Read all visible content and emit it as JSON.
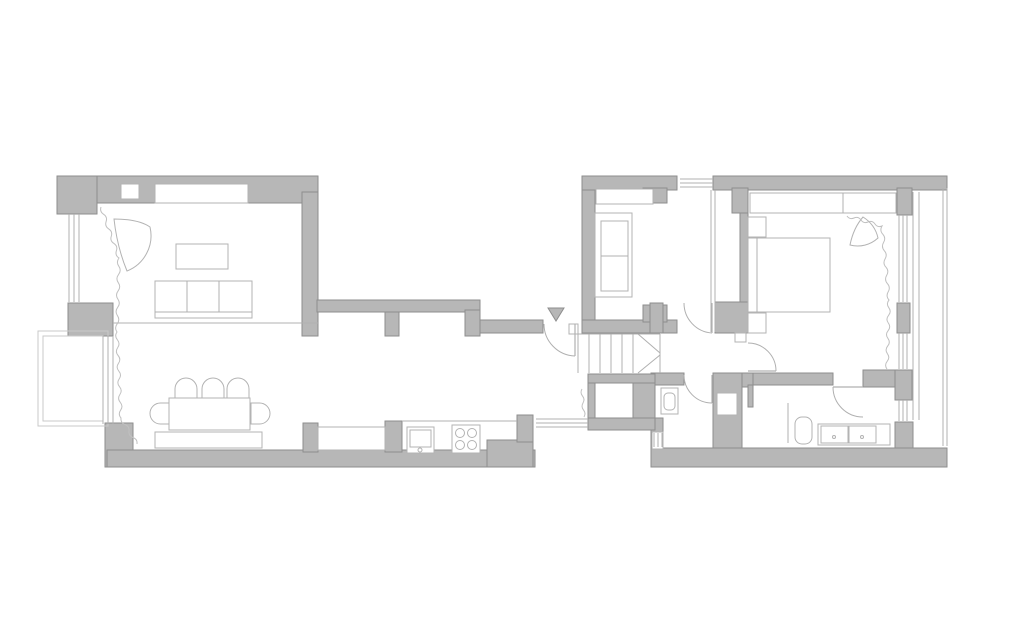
{
  "meta": {
    "title": "apartment-floor-plan",
    "canvas_width": 1024,
    "canvas_height": 633
  },
  "palette": {
    "background": "#ffffff",
    "wall_fill": "#b7b7b7",
    "wall_stroke": "#8e8e8e",
    "line": "#b0b0b0",
    "furniture_fill": "#ffffff",
    "furniture_stroke": "#b3b3b3",
    "curtain": "#c0c0c0",
    "door": "#b0b0b0",
    "outline": "#c9c9c9"
  },
  "floorplan": {
    "walls": [
      {
        "name": "wall-living-top",
        "x": 57,
        "y": 176,
        "w": 261,
        "h": 27
      },
      {
        "name": "wall-living-top-left-corner",
        "x": 57,
        "y": 176,
        "w": 40,
        "h": 38
      },
      {
        "name": "wall-living-right",
        "x": 302,
        "y": 192,
        "w": 16,
        "h": 144
      },
      {
        "name": "wall-corridor-top-band",
        "x": 317,
        "y": 300,
        "w": 163,
        "h": 12
      },
      {
        "name": "wall-corridor-pier-1",
        "x": 385,
        "y": 312,
        "w": 14,
        "h": 24
      },
      {
        "name": "wall-corridor-pier-2",
        "x": 465,
        "y": 310,
        "w": 15,
        "h": 26
      },
      {
        "name": "wall-entry-band",
        "x": 480,
        "y": 320,
        "w": 63,
        "h": 13
      },
      {
        "name": "wall-left-mid-pier",
        "x": 68,
        "y": 303,
        "w": 45,
        "h": 33
      },
      {
        "name": "wall-left-bottom-pier",
        "x": 105,
        "y": 423,
        "w": 28,
        "h": 44
      },
      {
        "name": "wall-bottom-left-band",
        "x": 107,
        "y": 450,
        "w": 428,
        "h": 17
      },
      {
        "name": "wall-kitchen-pier-left",
        "x": 303,
        "y": 423,
        "w": 15,
        "h": 29
      },
      {
        "name": "wall-kitchen-pier-mid",
        "x": 385,
        "y": 421,
        "w": 17,
        "h": 31
      },
      {
        "name": "wall-kitchen-step",
        "x": 487,
        "y": 440,
        "w": 46,
        "h": 27
      },
      {
        "name": "wall-kitchen-right-pier",
        "x": 517,
        "y": 415,
        "w": 16,
        "h": 27
      },
      {
        "name": "wall-right-top-band-left",
        "x": 582,
        "y": 176,
        "w": 95,
        "h": 14
      },
      {
        "name": "wall-right-top-band",
        "x": 713,
        "y": 176,
        "w": 234,
        "h": 14
      },
      {
        "name": "wall-right-block-left",
        "x": 582,
        "y": 190,
        "w": 13,
        "h": 142
      },
      {
        "name": "wall-small-room-pier",
        "x": 643,
        "y": 188,
        "w": 24,
        "h": 15
      },
      {
        "name": "wall-small-room-bottom",
        "x": 582,
        "y": 320,
        "w": 95,
        "h": 13
      },
      {
        "name": "wall-small-room-bottom-pier",
        "x": 643,
        "y": 305,
        "w": 24,
        "h": 17
      },
      {
        "name": "wall-hall-left-pier",
        "x": 650,
        "y": 303,
        "w": 13,
        "h": 30
      },
      {
        "name": "wall-bedroom-left-top",
        "x": 732,
        "y": 188,
        "w": 16,
        "h": 25
      },
      {
        "name": "wall-bedroom-left-thin",
        "x": 740,
        "y": 213,
        "w": 8,
        "h": 90
      },
      {
        "name": "wall-bedroom-left-bottom",
        "x": 732,
        "y": 303,
        "w": 16,
        "h": 30
      },
      {
        "name": "wall-hall-right-chunk",
        "x": 715,
        "y": 302,
        "w": 38,
        "h": 31
      },
      {
        "name": "wall-bedroom-bottom",
        "x": 713,
        "y": 373,
        "w": 40,
        "h": 14
      },
      {
        "name": "wall-bedroom-door-jamb",
        "x": 748,
        "y": 385,
        "w": 5,
        "h": 22
      },
      {
        "name": "wall-bath-top-left",
        "x": 753,
        "y": 373,
        "w": 80,
        "h": 12
      },
      {
        "name": "wall-bath-top-right",
        "x": 863,
        "y": 370,
        "w": 32,
        "h": 17
      },
      {
        "name": "wall-right-pier-top",
        "x": 897,
        "y": 188,
        "w": 15,
        "h": 27
      },
      {
        "name": "wall-right-pier-mid",
        "x": 897,
        "y": 303,
        "w": 13,
        "h": 30
      },
      {
        "name": "wall-right-pier-low",
        "x": 895,
        "y": 370,
        "w": 17,
        "h": 30
      },
      {
        "name": "wall-right-corner",
        "x": 895,
        "y": 422,
        "w": 18,
        "h": 30
      },
      {
        "name": "wall-shaft",
        "x": 713,
        "y": 373,
        "w": 29,
        "h": 75
      },
      {
        "name": "wall-toilet-top",
        "x": 651,
        "y": 373,
        "w": 33,
        "h": 12
      },
      {
        "name": "wall-toilet-left",
        "x": 651,
        "y": 418,
        "w": 12,
        "h": 49
      },
      {
        "name": "wall-understairs-band",
        "x": 588,
        "y": 374,
        "w": 67,
        "h": 9
      },
      {
        "name": "wall-understairs-left",
        "x": 588,
        "y": 383,
        "w": 7,
        "h": 44
      },
      {
        "name": "wall-understairs-right",
        "x": 633,
        "y": 383,
        "w": 22,
        "h": 47
      },
      {
        "name": "wall-understairs-bottom",
        "x": 588,
        "y": 418,
        "w": 67,
        "h": 12
      },
      {
        "name": "wall-bottom-right-band",
        "x": 651,
        "y": 448,
        "w": 296,
        "h": 19
      }
    ],
    "insets": [
      {
        "name": "niche-living-top-small",
        "x": 121,
        "y": 184,
        "w": 18,
        "h": 15
      },
      {
        "name": "cabinet-living-top",
        "x": 155,
        "y": 184,
        "w": 93,
        "h": 19
      },
      {
        "name": "radiator-dining",
        "x": 155,
        "y": 432,
        "w": 107,
        "h": 16
      },
      {
        "name": "niche-kitchen-window",
        "x": 318,
        "y": 427,
        "w": 67,
        "h": 23
      },
      {
        "name": "shaft-box",
        "x": 717,
        "y": 393,
        "w": 20,
        "h": 22
      },
      {
        "name": "toilet-window-inset",
        "x": 652,
        "y": 432,
        "w": 11,
        "h": 17
      },
      {
        "name": "entry-hinge-plate",
        "x": 569,
        "y": 324,
        "w": 9,
        "h": 10
      },
      {
        "name": "hall-door-stop",
        "x": 735,
        "y": 333,
        "w": 11,
        "h": 9
      }
    ],
    "outlines": [
      {
        "name": "balcony-outer",
        "x": 38,
        "y": 331,
        "w": 70,
        "h": 95
      },
      {
        "name": "balcony-inner",
        "x": 43,
        "y": 336,
        "w": 60,
        "h": 85
      }
    ],
    "furniture_rects": [
      {
        "name": "coffee-table",
        "x": 176,
        "y": 244,
        "w": 52,
        "h": 25
      },
      {
        "name": "sofa-body",
        "x": 155,
        "y": 281,
        "w": 97,
        "h": 37
      },
      {
        "name": "dining-table",
        "x": 169,
        "y": 398,
        "w": 81,
        "h": 32
      },
      {
        "name": "kitchen-sink-unit",
        "x": 407,
        "y": 427,
        "w": 27,
        "h": 26
      },
      {
        "name": "kitchen-sink-bowl",
        "x": 410,
        "y": 430,
        "w": 21,
        "h": 17
      },
      {
        "name": "stove",
        "x": 452,
        "y": 425,
        "w": 28,
        "h": 28
      },
      {
        "name": "small-room-shelf",
        "x": 596,
        "y": 189,
        "w": 57,
        "h": 15
      },
      {
        "name": "daybed-outer",
        "x": 595,
        "y": 213,
        "w": 37,
        "h": 84
      },
      {
        "name": "daybed-mattress",
        "x": 601,
        "y": 221,
        "w": 27,
        "h": 70
      },
      {
        "name": "wardrobe",
        "x": 750,
        "y": 193,
        "w": 146,
        "h": 20
      },
      {
        "name": "bed",
        "x": 748,
        "y": 238,
        "w": 82,
        "h": 74
      },
      {
        "name": "nightstand-top",
        "x": 748,
        "y": 217,
        "w": 18,
        "h": 20
      },
      {
        "name": "nightstand-bottom",
        "x": 748,
        "y": 313,
        "w": 18,
        "h": 20
      },
      {
        "name": "vanity-counter",
        "x": 818,
        "y": 424,
        "w": 72,
        "h": 21
      },
      {
        "name": "vanity-sink-left",
        "x": 821,
        "y": 426,
        "w": 27,
        "h": 17
      },
      {
        "name": "vanity-sink-right",
        "x": 849,
        "y": 426,
        "w": 27,
        "h": 17
      },
      {
        "name": "bath-fixture",
        "x": 795,
        "y": 417,
        "w": 17,
        "h": 27,
        "rx": 7
      },
      {
        "name": "wc-tank",
        "x": 661,
        "y": 388,
        "w": 17,
        "h": 26
      },
      {
        "name": "wc-bowl",
        "x": 664,
        "y": 393,
        "w": 11,
        "h": 17,
        "rx": 4
      }
    ],
    "chairs": [
      {
        "name": "dining-chair-1",
        "x": 175,
        "y": 378,
        "w": 22,
        "h": 20,
        "dir": "up"
      },
      {
        "name": "dining-chair-2",
        "x": 202,
        "y": 378,
        "w": 22,
        "h": 20,
        "dir": "up"
      },
      {
        "name": "dining-chair-3",
        "x": 227,
        "y": 378,
        "w": 22,
        "h": 20,
        "dir": "up"
      },
      {
        "name": "dining-chair-left",
        "x": 150,
        "y": 403,
        "w": 19,
        "h": 21,
        "dir": "left"
      },
      {
        "name": "dining-chair-right",
        "x": 251,
        "y": 403,
        "w": 19,
        "h": 21,
        "dir": "right"
      }
    ],
    "paths": [
      {
        "name": "living-armchair",
        "d": "M114,219 C128,219 141,221 150,227 A38,38 0 0 1 127,271 C120,254 116,237 114,219 Z"
      },
      {
        "name": "bedroom-armchair",
        "d": "M863,217 C871,222 876,229 878,238 A30,30 0 0 1 850,245 C852,235 856,225 863,217 Z"
      }
    ],
    "lines": [
      {
        "name": "sofa-back-line",
        "x1": 155,
        "y1": 312,
        "x2": 252,
        "y2": 312
      },
      {
        "name": "sofa-divider-1",
        "x1": 187,
        "y1": 281,
        "x2": 187,
        "y2": 312
      },
      {
        "name": "sofa-divider-2",
        "x1": 219,
        "y1": 281,
        "x2": 219,
        "y2": 312
      },
      {
        "name": "living-dining-divider",
        "x1": 113,
        "y1": 323,
        "x2": 318,
        "y2": 323
      },
      {
        "name": "kitchen-counter-edge",
        "x1": 402,
        "y1": 421,
        "x2": 517,
        "y2": 421
      },
      {
        "name": "daybed-seam",
        "x1": 601,
        "y1": 256,
        "x2": 628,
        "y2": 256
      },
      {
        "name": "wardrobe-divider",
        "x1": 843,
        "y1": 193,
        "x2": 843,
        "y2": 213
      },
      {
        "name": "bed-headboard-line",
        "x1": 757,
        "y1": 238,
        "x2": 757,
        "y2": 312
      },
      {
        "name": "small-room-partition-a",
        "x1": 711,
        "y1": 190,
        "x2": 711,
        "y2": 332
      },
      {
        "name": "small-room-partition-b",
        "x1": 715,
        "y1": 190,
        "x2": 715,
        "y2": 332
      },
      {
        "name": "shower-screen",
        "x1": 788,
        "y1": 403,
        "x2": 788,
        "y2": 443
      },
      {
        "name": "stairs-edge-top",
        "x1": 578,
        "y1": 334,
        "x2": 660,
        "y2": 334
      },
      {
        "name": "stairs-edge-left",
        "x1": 578,
        "y1": 334,
        "x2": 578,
        "y2": 373
      },
      {
        "name": "stairs-riser-1",
        "x1": 589,
        "y1": 334,
        "x2": 589,
        "y2": 373
      },
      {
        "name": "stairs-riser-2",
        "x1": 600,
        "y1": 334,
        "x2": 600,
        "y2": 373
      },
      {
        "name": "stairs-riser-3",
        "x1": 611,
        "y1": 334,
        "x2": 611,
        "y2": 373
      },
      {
        "name": "stairs-riser-4",
        "x1": 622,
        "y1": 334,
        "x2": 622,
        "y2": 373
      },
      {
        "name": "stairs-riser-5",
        "x1": 633,
        "y1": 334,
        "x2": 633,
        "y2": 373
      },
      {
        "name": "stairs-break-upper",
        "x1": 638,
        "y1": 334,
        "x2": 660,
        "y2": 353
      },
      {
        "name": "stairs-break-lower",
        "x1": 638,
        "y1": 373,
        "x2": 660,
        "y2": 355
      },
      {
        "name": "stairs-edge-right",
        "x1": 660,
        "y1": 334,
        "x2": 660,
        "y2": 373
      }
    ],
    "glazing": [
      {
        "name": "living-window-glazing",
        "lines": [
          [
            69,
            214,
            69,
            302
          ],
          [
            74,
            214,
            74,
            302
          ],
          [
            79,
            214,
            79,
            302
          ]
        ]
      },
      {
        "name": "dining-window-glazing",
        "lines": [
          [
            103,
            336,
            103,
            424
          ],
          [
            108,
            336,
            108,
            424
          ],
          [
            113,
            336,
            113,
            424
          ]
        ]
      },
      {
        "name": "small-room-window-glazing",
        "lines": [
          [
            680,
            179,
            713,
            179
          ],
          [
            680,
            183,
            713,
            183
          ],
          [
            680,
            187,
            713,
            187
          ]
        ]
      },
      {
        "name": "bedroom-window-upper-glazing",
        "lines": [
          [
            899,
            215,
            899,
            302
          ],
          [
            903,
            215,
            903,
            302
          ],
          [
            907,
            215,
            907,
            302
          ]
        ]
      },
      {
        "name": "bedroom-window-lower-glazing",
        "lines": [
          [
            899,
            333,
            899,
            369
          ],
          [
            903,
            333,
            903,
            369
          ],
          [
            907,
            333,
            907,
            369
          ]
        ]
      },
      {
        "name": "bathroom-window-glazing",
        "lines": [
          [
            899,
            400,
            899,
            421
          ],
          [
            903,
            400,
            903,
            421
          ],
          [
            907,
            400,
            907,
            421
          ]
        ]
      },
      {
        "name": "toilet-window-glazing",
        "lines": [
          [
            654,
            433,
            654,
            447
          ],
          [
            658,
            433,
            658,
            447
          ],
          [
            662,
            433,
            662,
            447
          ]
        ]
      },
      {
        "name": "loggia-face-lines",
        "lines": [
          [
            913,
            192,
            913,
            420
          ],
          [
            919,
            192,
            919,
            420
          ]
        ]
      },
      {
        "name": "balcony-railing-lines",
        "lines": [
          [
            943,
            188,
            943,
            446
          ],
          [
            947,
            188,
            947,
            446
          ]
        ]
      },
      {
        "name": "kitchen-glass-partition",
        "lines": [
          [
            536,
            419,
            588,
            419
          ],
          [
            536,
            423,
            588,
            423
          ],
          [
            536,
            427,
            588,
            427
          ]
        ]
      }
    ],
    "circles": [
      {
        "name": "stove-burner-1",
        "cx": 460,
        "cy": 433,
        "r": 4.5
      },
      {
        "name": "stove-burner-2",
        "cx": 472,
        "cy": 433,
        "r": 4.5
      },
      {
        "name": "stove-burner-3",
        "cx": 460,
        "cy": 445,
        "r": 4.5
      },
      {
        "name": "stove-burner-4",
        "cx": 472,
        "cy": 445,
        "r": 4.5
      },
      {
        "name": "kitchen-faucet",
        "cx": 420,
        "cy": 450,
        "r": 2
      },
      {
        "name": "vanity-drain-left",
        "cx": 834,
        "cy": 437,
        "r": 1.5
      },
      {
        "name": "vanity-drain-right",
        "cx": 862,
        "cy": 437,
        "r": 1.5
      }
    ],
    "doors": [
      {
        "name": "entry-door",
        "leaf": [
          575,
          324,
          575,
          356
        ],
        "arc": {
          "sx": 544,
          "sy": 324,
          "r": 32,
          "ex": 575,
          "ey": 356,
          "sweep": 0
        }
      },
      {
        "name": "small-room-door",
        "leaf": [
          712,
          303,
          712,
          333
        ],
        "arc": {
          "sx": 684,
          "sy": 303,
          "r": 30,
          "ex": 712,
          "ey": 333,
          "sweep": 0
        }
      },
      {
        "name": "toilet-door",
        "leaf": [
          712,
          375,
          712,
          403
        ],
        "arc": {
          "sx": 684,
          "sy": 375,
          "r": 28,
          "ex": 712,
          "ey": 403,
          "sweep": 0
        }
      },
      {
        "name": "bedroom-door",
        "leaf": [
          748,
          371,
          776,
          371
        ],
        "arc": {
          "sx": 748,
          "sy": 343,
          "r": 28,
          "ex": 776,
          "ey": 371,
          "sweep": 1
        }
      },
      {
        "name": "bathroom-door",
        "leaf": [
          833,
          387,
          863,
          387
        ],
        "arc": {
          "sx": 833,
          "sy": 387,
          "r": 30,
          "ex": 863,
          "ey": 417,
          "sweep": 0
        }
      }
    ],
    "curtains": [
      {
        "name": "curtain-living",
        "pts": [
          [
            101,
            207
          ],
          [
            119,
            258
          ],
          [
            117,
            332
          ],
          [
            121,
            418
          ],
          [
            137,
            444
          ]
        ],
        "amp": 3,
        "step": 8
      },
      {
        "name": "curtain-bedroom",
        "pts": [
          [
            847,
            216
          ],
          [
            882,
            226
          ],
          [
            889,
            300
          ],
          [
            887,
            369
          ]
        ],
        "amp": 3,
        "step": 8
      },
      {
        "name": "curtain-closet",
        "pts": [
          [
            582,
            389
          ],
          [
            584,
            417
          ]
        ],
        "amp": 2.5,
        "step": 7
      }
    ],
    "entrance_marker": {
      "points": "548,308 564,308 556,321"
    }
  }
}
